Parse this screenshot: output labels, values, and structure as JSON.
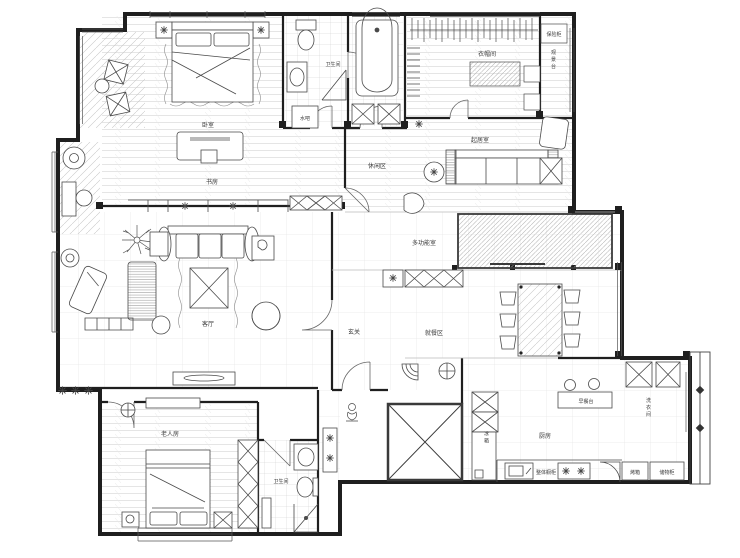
{
  "meta": {
    "type": "apartment-floor-plan",
    "style": "CAD line drawing"
  },
  "colors": {
    "background": "#ffffff",
    "wall": "#1f1f1f",
    "furniture_line": "#4a4a4a",
    "floor_line": "#d6d6d6",
    "label_text": "#3a3a3a"
  },
  "labels": {
    "master_bedroom": "卧室",
    "study": "书房",
    "master_bath": "卫生间",
    "water_bar": "水吧",
    "cloakroom": "衣帽间",
    "safe_box": "保险柜",
    "view_deck": "观景台",
    "sitting_room": "起居室",
    "leisure_area": "休闲区",
    "multi_room": "多功能室",
    "foyer": "玄关",
    "dining_area": "就餐区",
    "living_room": "客厅",
    "elder_room": "老人房",
    "bath_2": "卫生间",
    "kitchen": "厨房",
    "breakfast_bar": "早餐台",
    "laundry": "洗衣间",
    "cabinet_run": "整体橱柜",
    "fridge": "冰箱",
    "oven": "烤箱",
    "storage_cabinet": "储物柜"
  }
}
